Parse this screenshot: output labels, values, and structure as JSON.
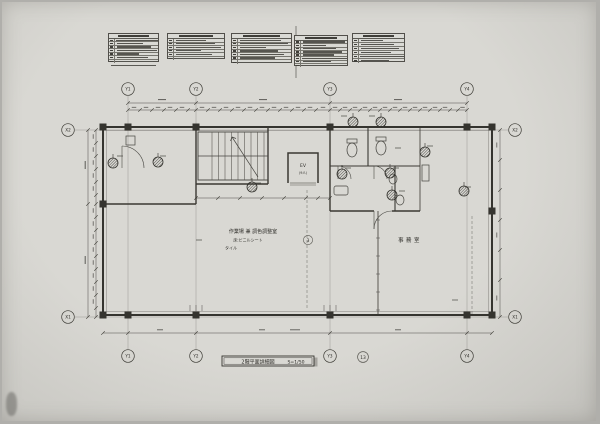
{
  "sheet": {
    "title_block": {
      "title": "2階平面詳細図",
      "scale": "S=1/50",
      "sheet_number": "13"
    },
    "detail_marker_number": "3"
  },
  "axes": {
    "y_top": [
      {
        "id": "Y1"
      },
      {
        "id": "Y2"
      },
      {
        "id": "Y3"
      },
      {
        "id": "Y4"
      }
    ],
    "y_bottom": [
      {
        "id": "Y1"
      },
      {
        "id": "Y2"
      },
      {
        "id": "Y3"
      },
      {
        "id": "Y4"
      }
    ],
    "x_left": [
      {
        "id": "X2"
      },
      {
        "id": "X1"
      }
    ],
    "x_right": [
      {
        "id": "X2"
      },
      {
        "id": "X1"
      }
    ]
  },
  "rooms": {
    "work_room": {
      "line1": "作業場 兼 調色調整室",
      "line2": "床:ビニルシート",
      "line3": "タイル"
    },
    "office": {
      "label": "事務室"
    },
    "elevator": {
      "line1": "EV",
      "line2": "(9人)"
    }
  },
  "spec_tables": {
    "items": [
      {
        "x": 108,
        "y": 33,
        "w": 51,
        "h": 29,
        "rows": 7,
        "note": true
      },
      {
        "x": 167,
        "y": 33,
        "w": 58,
        "h": 26,
        "rows": 6,
        "note": false
      },
      {
        "x": 231,
        "y": 33,
        "w": 61,
        "h": 30,
        "rows": 7,
        "note": false
      },
      {
        "x": 294,
        "y": 35,
        "w": 54,
        "h": 31,
        "rows": 8,
        "note": false
      },
      {
        "x": 352,
        "y": 33,
        "w": 53,
        "h": 29,
        "rows": 6,
        "note": false
      }
    ]
  }
}
